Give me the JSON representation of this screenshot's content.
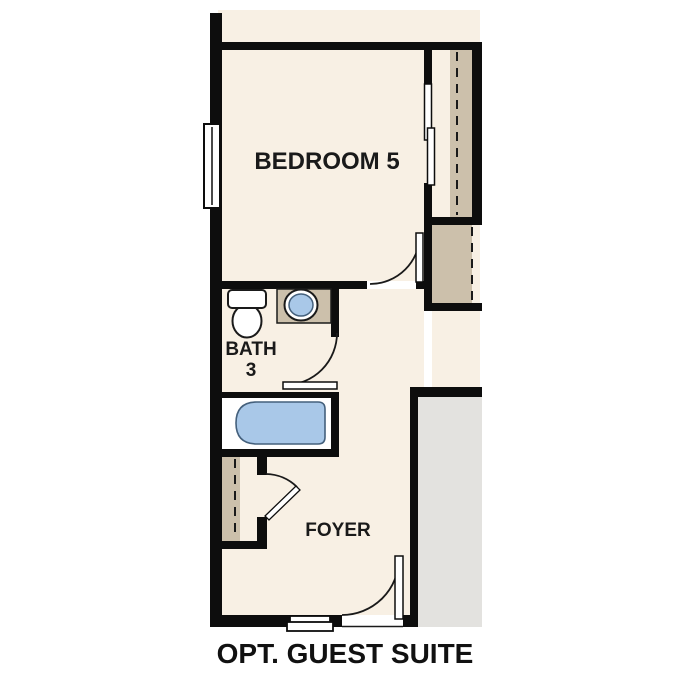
{
  "floorplan": {
    "plan_title": "OPT. GUEST SUITE",
    "rooms": {
      "bedroom": {
        "label": "BEDROOM 5"
      },
      "bath": {
        "label_line1": "BATH",
        "label_line2": "3"
      },
      "foyer": {
        "label": "FOYER"
      }
    },
    "fixtures": [
      "window",
      "bypass-closet-doors",
      "closet-rod-dashed-line",
      "toilet",
      "sink-vanity",
      "bathtub",
      "bedroom-door-swing",
      "bath-door-swing",
      "foyer-closet-door-swing",
      "front-door-swing",
      "entry-step",
      "garage-area"
    ],
    "colors": {
      "wall_black": "#0d0d0d",
      "floor_cream": "#f8f0e4",
      "closet_tan": "#ccc0ab",
      "fixture_blue": "#a9c8e8",
      "fixture_blue_outline": "#44607c",
      "garage_gray": "#e3e2df",
      "line_black": "#1a1a1a",
      "background": "#ffffff"
    }
  }
}
